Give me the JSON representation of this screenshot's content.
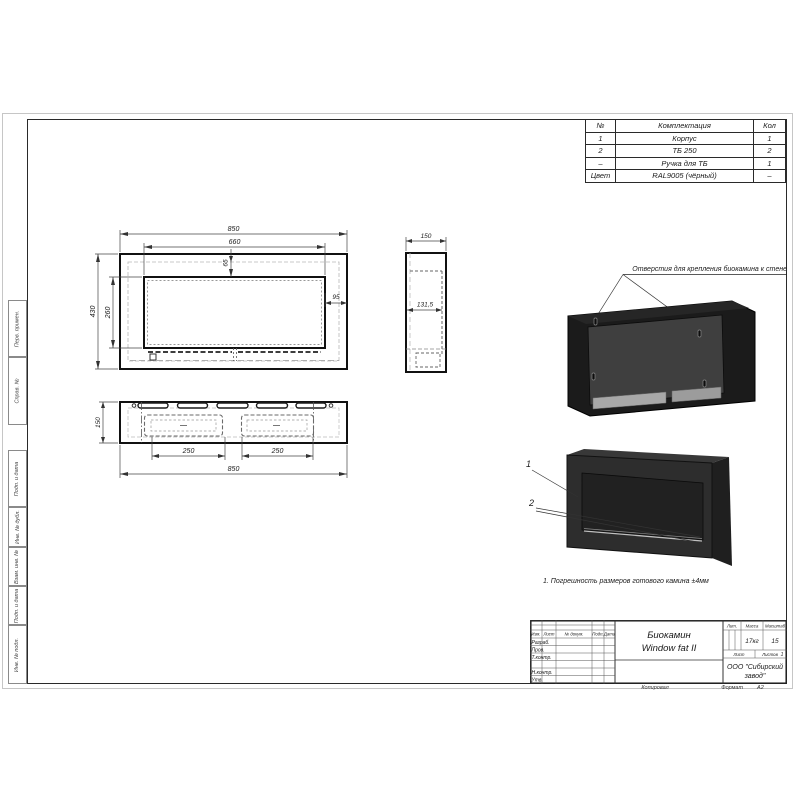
{
  "colors": {
    "line": "#1a1a1a",
    "body_dark": "#2d2d2d",
    "back_panel": "#3f3f3f",
    "metal": "#a8a8a8"
  },
  "parts_table": {
    "headers": [
      "№",
      "Комплектация",
      "Кол"
    ],
    "rows": [
      [
        "1",
        "Корпус",
        "1"
      ],
      [
        "2",
        "ТБ 250",
        "2"
      ],
      [
        "–",
        "Ручка для ТБ",
        "1"
      ],
      [
        "Цвет",
        "RAL9005 (чёрный)",
        "–"
      ]
    ]
  },
  "dims": {
    "front": {
      "width_total": "850",
      "width_window": "660",
      "height_total": "430",
      "height_window": "260",
      "top_offset": "65",
      "side_offset": "95"
    },
    "side": {
      "depth": "150",
      "inner_width": "131,5"
    },
    "bottom": {
      "depth": "150",
      "slot_left": "250",
      "slot_right": "250",
      "width_total": "850"
    }
  },
  "annotations": {
    "mounting": "Отверстия для крепления биокамина к стене",
    "note": "1. Погрешность размеров готового камина ±4мм",
    "callout_body": "1",
    "callout_burner": "2"
  },
  "title_block": {
    "product_line1": "Биокамин",
    "product_line2": "Window fat II",
    "cols": {
      "izm": "Изм.",
      "list": "Лист",
      "ndokum": "№ докум.",
      "podp": "Подп.",
      "data": "Дата"
    },
    "rows": {
      "razrab": "Разраб.",
      "prov": "Пров.",
      "tkontr": "Т.контр.",
      "nkontr": "Н.контр.",
      "utv": "Утв."
    },
    "lit": "Лит.",
    "massa": "Масса",
    "masshtab": "Масштаб",
    "massa_value": "17кг",
    "masshtab_value": "15",
    "list": "Лист",
    "listov": "Листов",
    "listov_value": "1",
    "company_line1": "ООО \"Сибирский",
    "company_line2": "завод\"",
    "kopiroval": "Копировал",
    "format_label": "Формат",
    "format_value": "А2"
  },
  "frame_labels": [
    "Перв. примен.",
    "Справ. №",
    "Подп. и дата",
    "Инв. № дубл.",
    "Взам. инв. №",
    "Подп. и дата",
    "Инв. № подл."
  ]
}
